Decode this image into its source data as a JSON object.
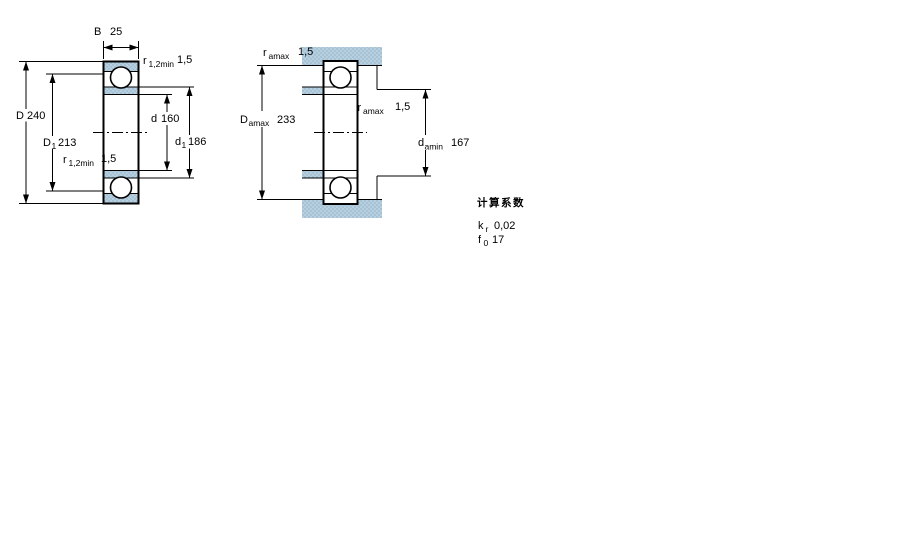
{
  "figure_left": {
    "dim_B": {
      "sym": "B",
      "value": "25"
    },
    "dim_r_top": {
      "sym": "r",
      "sub": "1,2min",
      "value": "1,5"
    },
    "dim_D": {
      "sym": "D",
      "value": "240"
    },
    "dim_D1": {
      "sym": "D",
      "sub": "1",
      "value": "213"
    },
    "dim_r_side": {
      "sym": "r",
      "sub": "1,2min",
      "value": "1,5"
    },
    "dim_d": {
      "sym": "d",
      "value": "160"
    },
    "dim_d1": {
      "sym": "d",
      "sub": "1",
      "value": "186"
    }
  },
  "figure_right": {
    "dim_r_top": {
      "sym": "r",
      "sub": "amax",
      "value": "1,5"
    },
    "dim_Damax": {
      "sym": "D",
      "sub": "amax",
      "value": "233"
    },
    "dim_r_mid": {
      "sym": "r",
      "sub": "amax",
      "value": "1,5"
    },
    "dim_damin": {
      "sym": "d",
      "sub": "amin",
      "value": "167"
    }
  },
  "calculation_factors": {
    "title": "计算系数",
    "kr": {
      "sym": "k",
      "sub": "r",
      "value": "0,02"
    },
    "f0": {
      "sym": "f",
      "sub": "0",
      "value": "17"
    }
  },
  "colors": {
    "bearing_fill": "#b7cfdf",
    "bearing_dot": "#8cb0c6",
    "line": "#000000",
    "background": "#ffffff"
  }
}
